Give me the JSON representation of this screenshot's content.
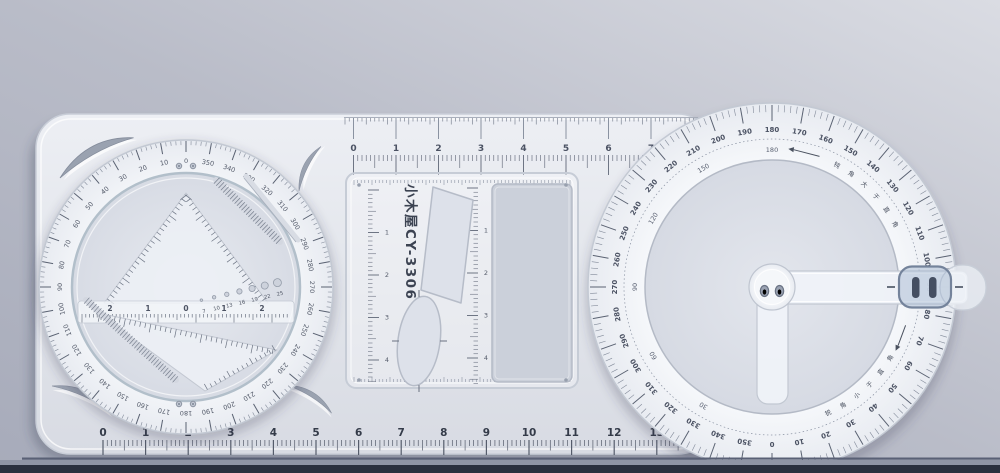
{
  "photo": {
    "background_color": "#b9bcc8",
    "table_edge_color": "#2a303f",
    "plate_color": "#e2e5eb",
    "ring_color": "#f2f4f8",
    "slider_tint": "#a4b5cf"
  },
  "device": {
    "brand_text": "小木屋CY-3306",
    "top_ruler_labels": [
      "0",
      "1",
      "2",
      "3",
      "4",
      "5",
      "6",
      "7"
    ],
    "bottom_ruler_labels": [
      "0",
      "1",
      "2",
      "3",
      "4",
      "5",
      "6",
      "7",
      "8",
      "9",
      "10",
      "11",
      "12",
      "13"
    ],
    "stencil_panel": {
      "left_scale_labels": [
        "1",
        "2",
        "3",
        "4"
      ],
      "mid_scale_labels": [
        "1",
        "2",
        "3",
        "4"
      ]
    },
    "left_dial": {
      "degree_labels": [
        "0",
        "10",
        "20",
        "30",
        "40",
        "50",
        "60",
        "70",
        "80",
        "90",
        "100",
        "110",
        "120",
        "130",
        "140",
        "150",
        "160",
        "170",
        "180",
        "190",
        "200",
        "210",
        "220",
        "230",
        "240",
        "250",
        "260",
        "270",
        "280",
        "290",
        "300",
        "310",
        "320",
        "330",
        "340",
        "350"
      ],
      "center_scale_labels": [
        "2",
        "1",
        "0",
        "1",
        "2"
      ],
      "hole_template_labels": [
        "7",
        "10",
        "13",
        "16",
        "19",
        "22",
        "25"
      ]
    },
    "protractor": {
      "outer_degree_labels": [
        "0",
        "10",
        "20",
        "30",
        "40",
        "50",
        "60",
        "70",
        "80",
        "90",
        "100",
        "110",
        "120",
        "130",
        "140",
        "150",
        "160",
        "170",
        "180",
        "190",
        "200",
        "210",
        "220",
        "230",
        "240",
        "250",
        "260",
        "270",
        "280",
        "290",
        "300",
        "310",
        "320",
        "330",
        "340",
        "350"
      ],
      "inner_degree_labels": [
        "30",
        "60",
        "90",
        "120",
        "150",
        "180"
      ],
      "obtuse_note": "钝角大于直角",
      "acute_note": "锐角小于直角"
    }
  }
}
